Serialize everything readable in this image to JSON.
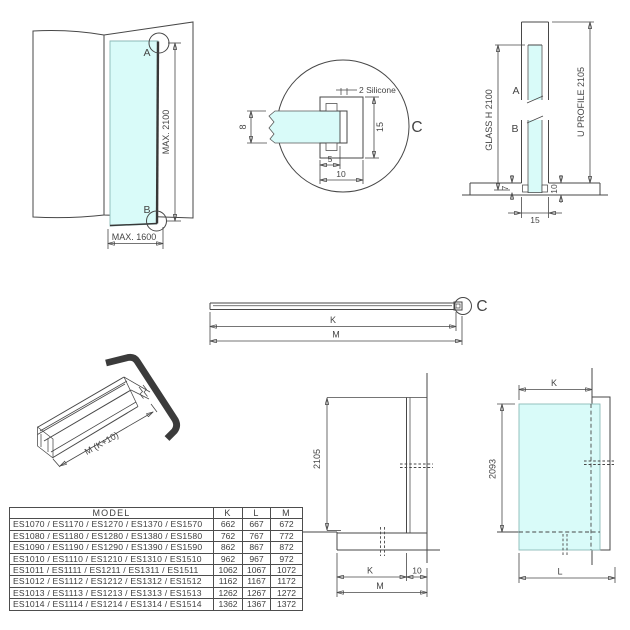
{
  "colors": {
    "glass": "#d9fbf9",
    "line": "#474747",
    "text": "#454545",
    "seal": "#3b3b3b",
    "hatch": "#777777"
  },
  "front_view": {
    "point_a": "A",
    "point_b": "B",
    "max_height": "MAX. 2100",
    "max_width": "MAX. 1600"
  },
  "detail_c": {
    "callout": "C",
    "silicone_note": "2 Silicone",
    "glass_thickness": "8",
    "profile_height": "15",
    "glass_inset": "5",
    "profile_depth": "10"
  },
  "vertical_section": {
    "point_a": "A",
    "point_b": "B",
    "glass_height": "GLASS H 2100",
    "u_profile": "U PROFILE 2105",
    "dim_7": "7",
    "dim_10": "10",
    "dim_15": "15"
  },
  "profile_length": {
    "callout": "C",
    "dim_k": "K",
    "dim_m": "M"
  },
  "profile_3d": {
    "length_label": "M (K+10)"
  },
  "side_section": {
    "height": "2105",
    "dim_k": "K",
    "dim_10": "10",
    "dim_m": "M"
  },
  "front_elevation": {
    "dim_k": "K",
    "height": "2093",
    "dim_l": "L"
  },
  "table": {
    "headers": [
      "MODEL",
      "K",
      "L",
      "M"
    ],
    "rows": [
      {
        "model": "ES1070 / ES1170 / ES1270 / ES1370 / ES1570",
        "k": "662",
        "l": "667",
        "m": "672"
      },
      {
        "model": "ES1080 / ES1180 / ES1280 / ES1380 / ES1580",
        "k": "762",
        "l": "767",
        "m": "772"
      },
      {
        "model": "ES1090 / ES1190 / ES1290 / ES1390 / ES1590",
        "k": "862",
        "l": "867",
        "m": "872"
      },
      {
        "model": "ES1010 / ES1110 / ES1210 / ES1310 / ES1510",
        "k": "962",
        "l": "967",
        "m": "972"
      },
      {
        "model": "ES1011 / ES1111 / ES1211 / ES1311 / ES1511",
        "k": "1062",
        "l": "1067",
        "m": "1072"
      },
      {
        "model": "ES1012 / ES1112 / ES1212 / ES1312 / ES1512",
        "k": "1162",
        "l": "1167",
        "m": "1172"
      },
      {
        "model": "ES1013 / ES1113 / ES1213 / ES1313 / ES1513",
        "k": "1262",
        "l": "1267",
        "m": "1272"
      },
      {
        "model": "ES1014 / ES1114 / ES1214 / ES1314 / ES1514",
        "k": "1362",
        "l": "1367",
        "m": "1372"
      }
    ]
  }
}
